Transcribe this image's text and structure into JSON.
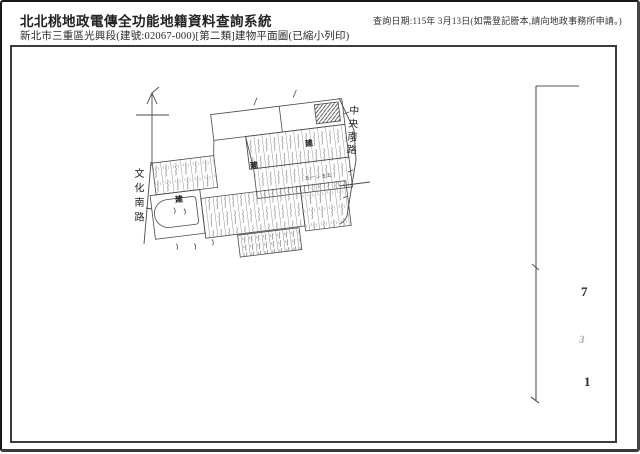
{
  "header": {
    "title": "北北桃地政電傳全功能地籍資料查詢系統",
    "subtitle": "新北市三重區光興段(建號:02067-000)[第二類]建物平面圖(已縮小列印)",
    "query_date_note": "查詢日期:115年 3月13日(如需登記謄本,請向地政事務所申請。)"
  },
  "map": {
    "street_right": "中央南路",
    "street_left": "文化南路",
    "building_marker": "建",
    "dimension_note": "五一—五五",
    "margin_marks": [
      "7",
      "3",
      "1"
    ]
  }
}
